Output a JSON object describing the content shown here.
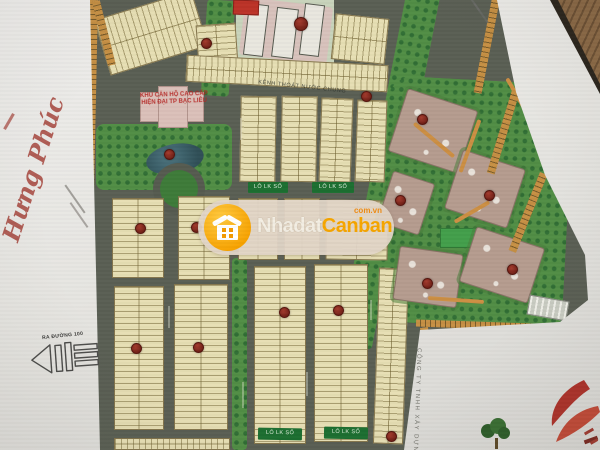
{
  "watermark": {
    "brand_part1": "Nhadat",
    "brand_part2": "Canban",
    "brand_tld": "com.vn",
    "pill_color": "#E2D5C7",
    "logo_color": "#F7A200",
    "part1_color": "#F3EEE3",
    "part2_color": "#F7A600"
  },
  "map": {
    "lot_label": "LÔ LK SỐ",
    "road_label_top": "KÊNH THOÁT NƯỚC CHUNG",
    "school_overlay_line1": "KHU CĂN HỘ CAO CẤP",
    "school_overlay_line2": "HIỆN ĐẠI TP BẠC LIÊU",
    "marker_color": "#8E2B20",
    "lot_fill_color": "#E8DFB2",
    "road_color": "#5A5F54",
    "park_color": "#4F8F42",
    "apartment_color": "#B69C8E"
  },
  "annotations": {
    "signature": "Hưng Phúc",
    "exit_label": "RA ĐƯỜNG 100",
    "company_vertical": "CÔNG TY TNHH XÂY DỰNG"
  }
}
